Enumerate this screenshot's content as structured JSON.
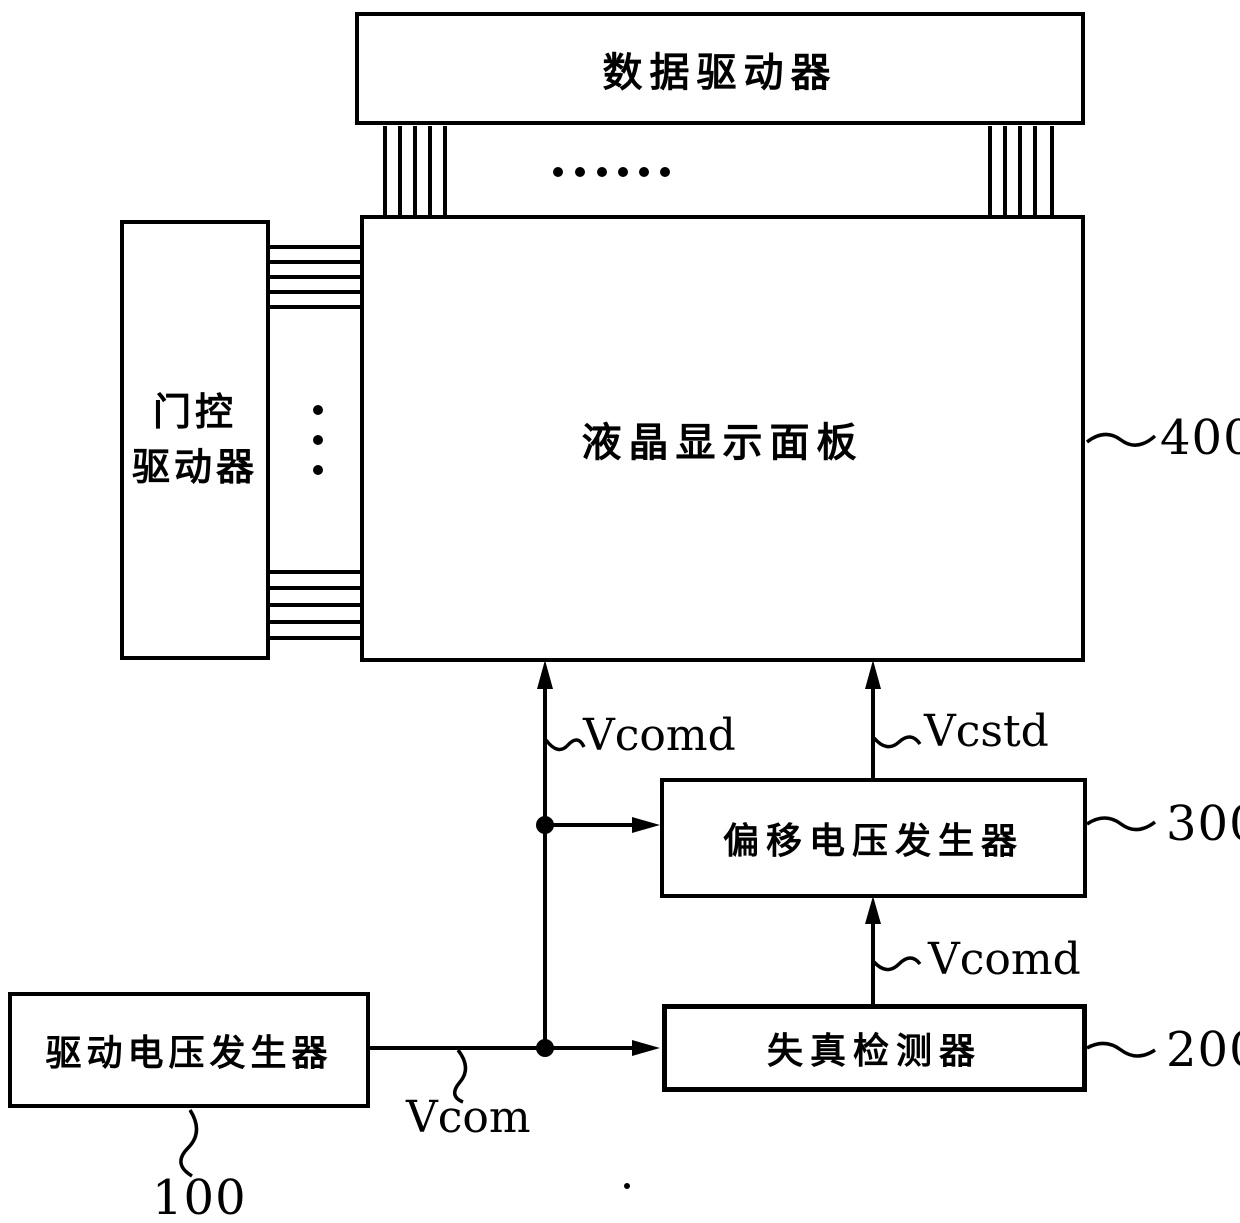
{
  "figure": {
    "colors": {
      "ink": "#000000",
      "background": "#ffffff"
    },
    "blocks": {
      "data_driver": {
        "label": "数据驱动器"
      },
      "gate_driver": {
        "label": "门控\n驱动器"
      },
      "lcd_panel": {
        "label": "液晶显示面板",
        "ref": "400"
      },
      "offset_voltage_generator": {
        "label": "偏移电压发生器",
        "ref": "300"
      },
      "distortion_detector": {
        "label": "失真检测器",
        "ref": "200"
      },
      "driving_voltage_generator": {
        "label": "驱动电压发生器",
        "ref": "100"
      }
    },
    "signal_labels": {
      "vcomd_to_panel": "Vcomd",
      "vcstd_to_panel": "Vcstd",
      "vcomd_to_offset": "Vcomd",
      "vcom": "Vcom"
    }
  }
}
